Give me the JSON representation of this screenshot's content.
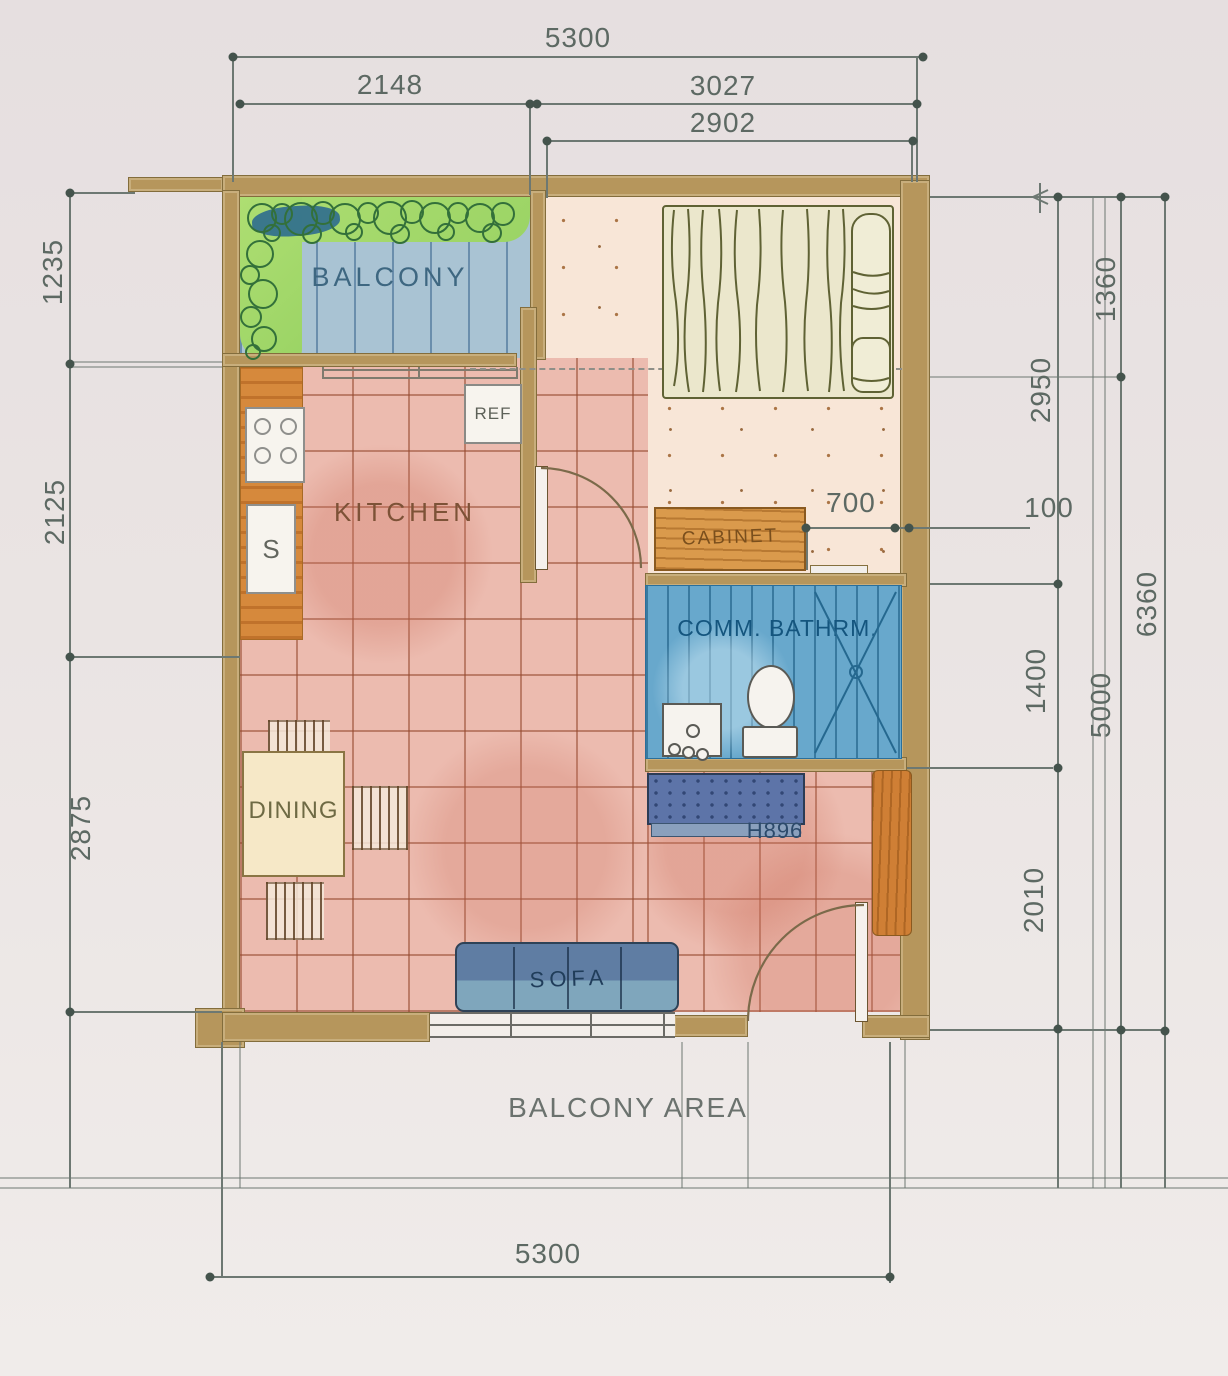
{
  "dims": {
    "top_total": "5300",
    "top_left": "2148",
    "top_right": "3027",
    "top_inner": "2902",
    "left_1": "1235",
    "left_2": "2125",
    "left_3": "2875",
    "right_bedrm": "2950",
    "right_bath": "1400",
    "right_living": "2010",
    "right_upper": "1360",
    "right_lower": "5000",
    "right_total": "6360",
    "cabinet_gap": "700",
    "wall_thickness": "100",
    "bottom_total": "5300"
  },
  "labels": {
    "balcony": "BALCONY",
    "bedroom": "BEDRM. 1",
    "kitchen": "KITCHEN",
    "cabinet": "CABINET",
    "bathroom": "COMM. BATHRM.",
    "dining": "DINING",
    "sofa": "SOFA",
    "fridge": "REF",
    "sink": "S",
    "dresser_code": "H896",
    "balcony_area": "BALCONY AREA"
  },
  "colors": {
    "wall_tan": "#b6965c",
    "balcony_floor_blue": "#a9c3d3",
    "plant_green": "#a4d96e",
    "bedroom_floor": "#f8e6d7",
    "tile_floor_pink": "#ecbbaf",
    "bathroom_blue": "#68a8cc",
    "counter_orange": "#d6893c",
    "cabinet_orange": "#da9a4c",
    "dresser_blue": "#5d74a8",
    "sofa_blue": "#6d8cab",
    "dim_line_gray": "#6d7872"
  }
}
